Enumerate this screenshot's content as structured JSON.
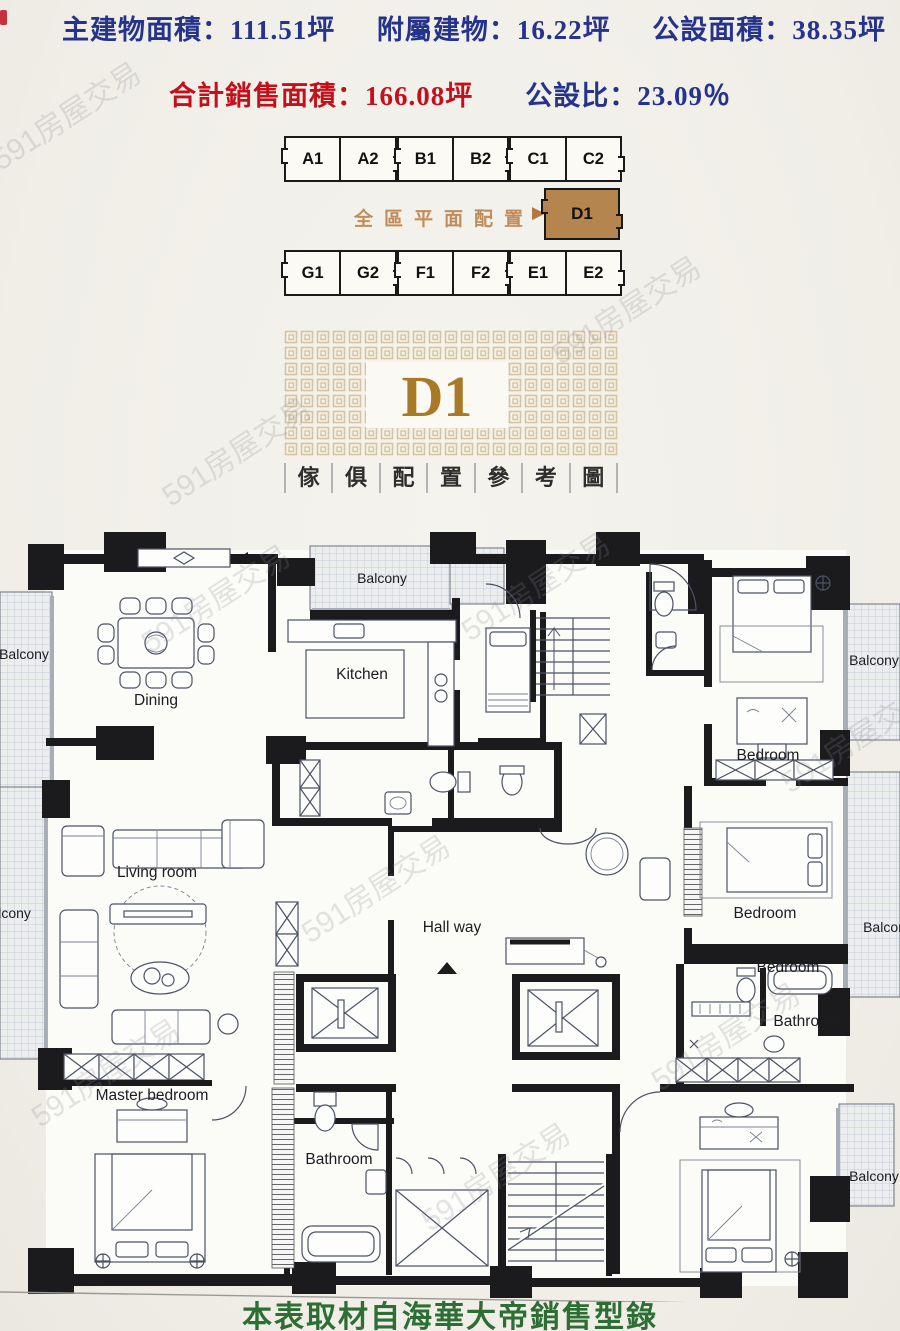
{
  "stats": {
    "line1": [
      "主建物面積：111.51坪",
      "附屬建物：16.22坪",
      "公設面積：38.35坪"
    ],
    "total": "合計銷售面積：166.08坪",
    "ratio": "公設比：23.09％",
    "primary_color": "#25338c",
    "highlight_color": "#c5101c"
  },
  "unit_selector": {
    "caption": "全區平面配置",
    "arrow": "▶",
    "rows": [
      [
        [
          "A1",
          "A2"
        ],
        [
          "B1",
          "B2"
        ],
        [
          "C1",
          "C2"
        ]
      ],
      [
        [
          "G1",
          "G2"
        ],
        [
          "F1",
          "F2"
        ],
        [
          "E1",
          "E2"
        ]
      ]
    ],
    "selected_unit": "D1",
    "selected_color": "#b5854f"
  },
  "logo": {
    "unit": "D1",
    "accent_color": "#a87a28",
    "pattern_color": "#d8c49c",
    "caption_chars": [
      "傢",
      "俱",
      "配",
      "置",
      "參",
      "考",
      "圖"
    ]
  },
  "floorplan": {
    "labels": [
      {
        "text": "Balcony"
      },
      {
        "text": "Kitchen"
      },
      {
        "text": "Dining"
      },
      {
        "text": "Balcony"
      },
      {
        "text": "Living room"
      },
      {
        "text": "Balcony"
      },
      {
        "text": "Hall way"
      },
      {
        "text": "Master bedroom"
      },
      {
        "text": "Bathroom"
      },
      {
        "text": "Bedroom"
      },
      {
        "text": "Balcony"
      },
      {
        "text": "Bedroom"
      },
      {
        "text": "Balcony"
      },
      {
        "text": "Bedroom"
      },
      {
        "text": "Bathroom"
      },
      {
        "text": "Balcony"
      }
    ]
  },
  "watermark": {
    "text": "591房屋交易"
  },
  "footer": {
    "caption": "本表取材自海華大帝銷售型錄",
    "color": "#2d6e35"
  }
}
